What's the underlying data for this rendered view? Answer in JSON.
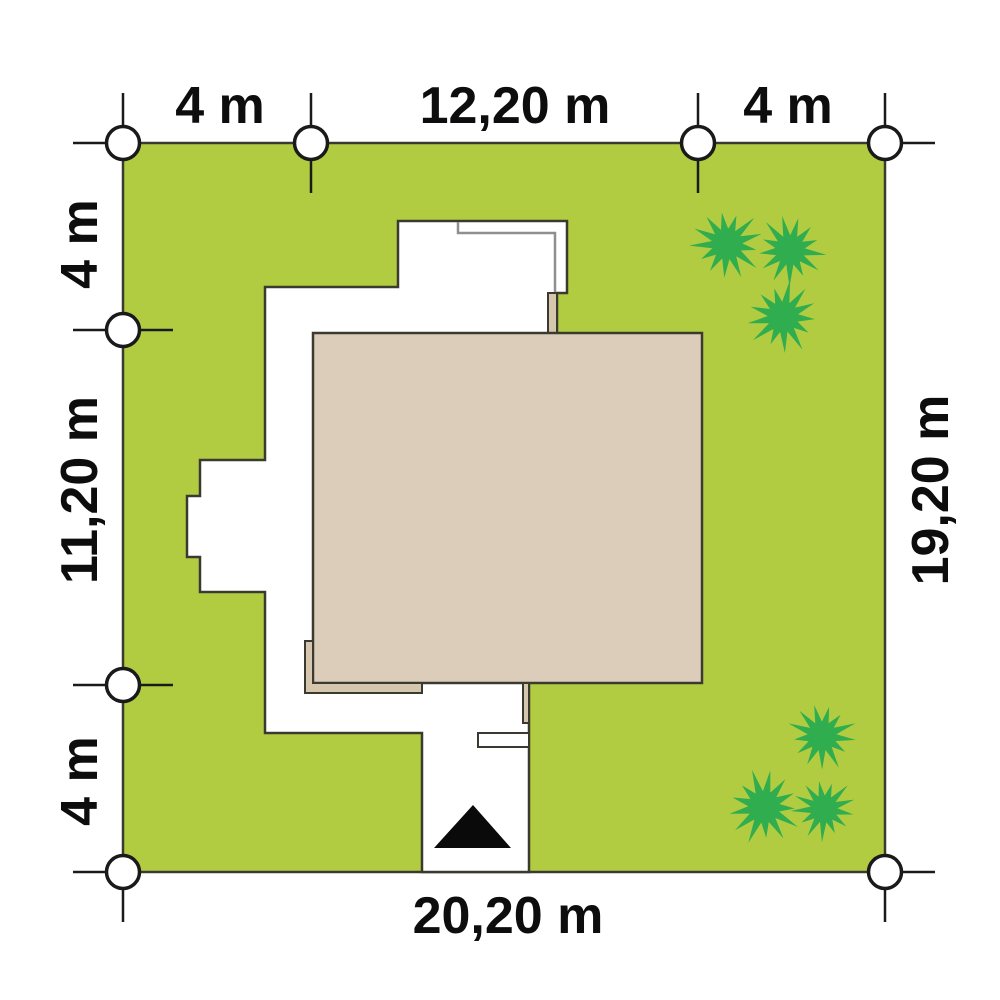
{
  "colors": {
    "background": "#ffffff",
    "plot_green": "#b2cc42",
    "tree_green": "#2fad4f",
    "roof_beige": "#dccdba",
    "eave_beige": "#d6c6ae",
    "house_white": "#ffffff",
    "outline_dark": "#3a3a30",
    "inner_wall_gray": "#8f8f8f",
    "line_black": "#1a1a1a",
    "marker_white": "#ffffff",
    "arrow_black": "#0a0a0a",
    "text_black": "#0d0d0d"
  },
  "dimension_labels": {
    "top": [
      {
        "label": "4 m",
        "x": 220,
        "y": 106,
        "orientation": "horizontal"
      },
      {
        "label": "12,20 m",
        "x": 515,
        "y": 106,
        "orientation": "horizontal"
      },
      {
        "label": "4 m",
        "x": 788,
        "y": 106,
        "orientation": "horizontal"
      }
    ],
    "left": [
      {
        "label": "4 m",
        "x": 80,
        "y": 244,
        "orientation": "vertical"
      },
      {
        "label": "11,20 m",
        "x": 80,
        "y": 490,
        "orientation": "vertical"
      },
      {
        "label": "4 m",
        "x": 80,
        "y": 781,
        "orientation": "vertical"
      }
    ],
    "right": [
      {
        "label": "19,20 m",
        "x": 931,
        "y": 490,
        "orientation": "vertical"
      }
    ],
    "bottom": [
      {
        "label": "20,20 m",
        "x": 508,
        "y": 916,
        "orientation": "horizontal"
      }
    ]
  },
  "survey_markers": [
    {
      "x": 123,
      "y": 143,
      "ticks": [
        "up",
        "left"
      ]
    },
    {
      "x": 311,
      "y": 143,
      "ticks": [
        "up",
        "down"
      ]
    },
    {
      "x": 698,
      "y": 143,
      "ticks": [
        "up",
        "down"
      ]
    },
    {
      "x": 885,
      "y": 143,
      "ticks": [
        "up",
        "right"
      ]
    },
    {
      "x": 123,
      "y": 330,
      "ticks": [
        "left",
        "right"
      ]
    },
    {
      "x": 123,
      "y": 685,
      "ticks": [
        "left",
        "right"
      ]
    },
    {
      "x": 123,
      "y": 872,
      "ticks": [
        "left",
        "down"
      ]
    },
    {
      "x": 885,
      "y": 872,
      "ticks": [
        "right",
        "down"
      ]
    }
  ],
  "trees": [
    {
      "x": 727,
      "y": 244,
      "r": 34,
      "rot": 0.2
    },
    {
      "x": 790,
      "y": 250,
      "r": 33,
      "rot": 1.1
    },
    {
      "x": 783,
      "y": 317,
      "r": 34,
      "rot": 2.0
    },
    {
      "x": 822,
      "y": 736,
      "r": 32,
      "rot": 0.6
    },
    {
      "x": 764,
      "y": 807,
      "r": 35,
      "rot": 1.5
    },
    {
      "x": 824,
      "y": 809,
      "r": 30,
      "rot": 2.6
    }
  ]
}
